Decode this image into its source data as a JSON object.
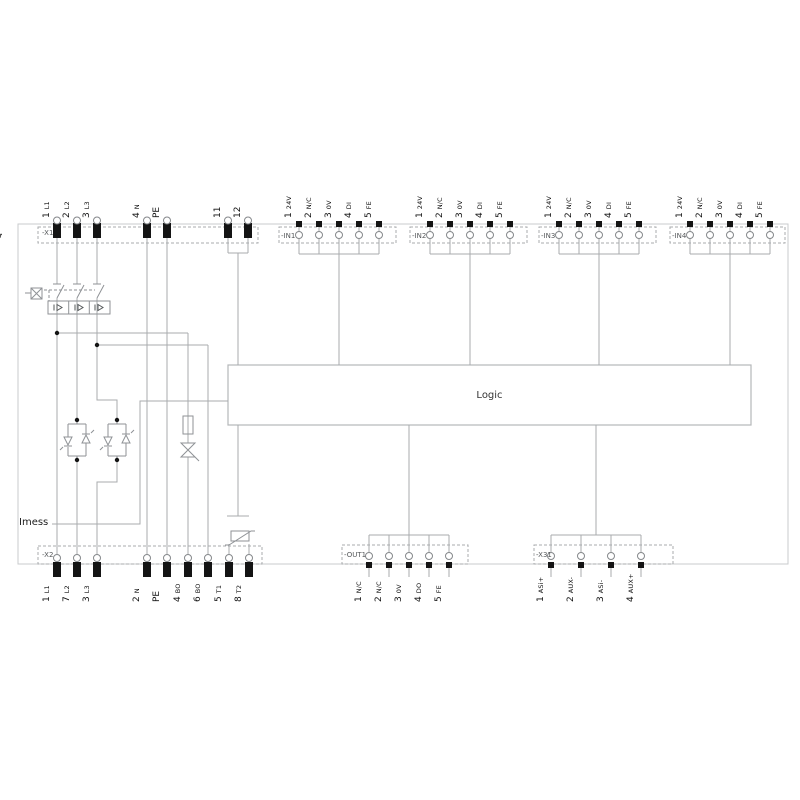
{
  "device": {
    "reference": "-Q"
  },
  "logic": {
    "label": "Logic"
  },
  "measurement": {
    "label": "Imess"
  },
  "colors": {
    "wire": "#a8abae",
    "frame": "#c9cbcd",
    "dark": "#141414",
    "text": "#1a1a1a"
  },
  "symbols": [
    "circuit-breaker-manual-actuator-icon",
    "overcurrent-release-icon",
    "antiparallel-thyristor-pair-icon",
    "fuse-icon",
    "triac-icon",
    "functional-earth-icon",
    "thermistor-icon"
  ],
  "blocks": [
    {
      "id": "x1",
      "name": "-X1",
      "position": "top",
      "terminals": [
        {
          "num": "1",
          "label": "L1"
        },
        {
          "num": "2",
          "label": "L2"
        },
        {
          "num": "3",
          "label": "L3"
        },
        {
          "num": "4",
          "label": "N"
        },
        {
          "num": "",
          "label": "PE"
        },
        {
          "num": "11",
          "label": ""
        },
        {
          "num": "12",
          "label": ""
        }
      ]
    },
    {
      "id": "in1",
      "name": "-IN1",
      "position": "top",
      "terminals": [
        {
          "num": "1",
          "label": "24V"
        },
        {
          "num": "2",
          "label": "N/C"
        },
        {
          "num": "3",
          "label": "0V"
        },
        {
          "num": "4",
          "label": "DI"
        },
        {
          "num": "5",
          "label": "FE"
        }
      ]
    },
    {
      "id": "in2",
      "name": "-IN2",
      "position": "top",
      "terminals": [
        {
          "num": "1",
          "label": "24V"
        },
        {
          "num": "2",
          "label": "N/C"
        },
        {
          "num": "3",
          "label": "0V"
        },
        {
          "num": "4",
          "label": "DI"
        },
        {
          "num": "5",
          "label": "FE"
        }
      ]
    },
    {
      "id": "in3",
      "name": "-IN3",
      "position": "top",
      "terminals": [
        {
          "num": "1",
          "label": "24V"
        },
        {
          "num": "2",
          "label": "N/C"
        },
        {
          "num": "3",
          "label": "0V"
        },
        {
          "num": "4",
          "label": "DI"
        },
        {
          "num": "5",
          "label": "FE"
        }
      ]
    },
    {
      "id": "in4",
      "name": "-IN4",
      "position": "top",
      "terminals": [
        {
          "num": "1",
          "label": "24V"
        },
        {
          "num": "2",
          "label": "N/C"
        },
        {
          "num": "3",
          "label": "0V"
        },
        {
          "num": "4",
          "label": "DI"
        },
        {
          "num": "5",
          "label": "FE"
        }
      ]
    },
    {
      "id": "x2",
      "name": "-X2",
      "position": "bottom",
      "terminals": [
        {
          "num": "1",
          "label": "L1"
        },
        {
          "num": "7",
          "label": "L2"
        },
        {
          "num": "3",
          "label": "L3"
        },
        {
          "num": "2",
          "label": "N"
        },
        {
          "num": "",
          "label": "PE"
        },
        {
          "num": "4",
          "label": "BO"
        },
        {
          "num": "6",
          "label": "BO"
        },
        {
          "num": "5",
          "label": "T1"
        },
        {
          "num": "8",
          "label": "T2"
        }
      ]
    },
    {
      "id": "out1",
      "name": "-OUT1",
      "position": "bottom",
      "terminals": [
        {
          "num": "1",
          "label": "N/C"
        },
        {
          "num": "2",
          "label": "N/C"
        },
        {
          "num": "3",
          "label": "0V"
        },
        {
          "num": "4",
          "label": "DO"
        },
        {
          "num": "5",
          "label": "FE"
        }
      ]
    },
    {
      "id": "x31",
      "name": "-X31",
      "position": "bottom",
      "terminals": [
        {
          "num": "1",
          "label": "ASi+"
        },
        {
          "num": "2",
          "label": "AUX-"
        },
        {
          "num": "3",
          "label": "ASi-"
        },
        {
          "num": "4",
          "label": "AUX+"
        }
      ]
    }
  ]
}
